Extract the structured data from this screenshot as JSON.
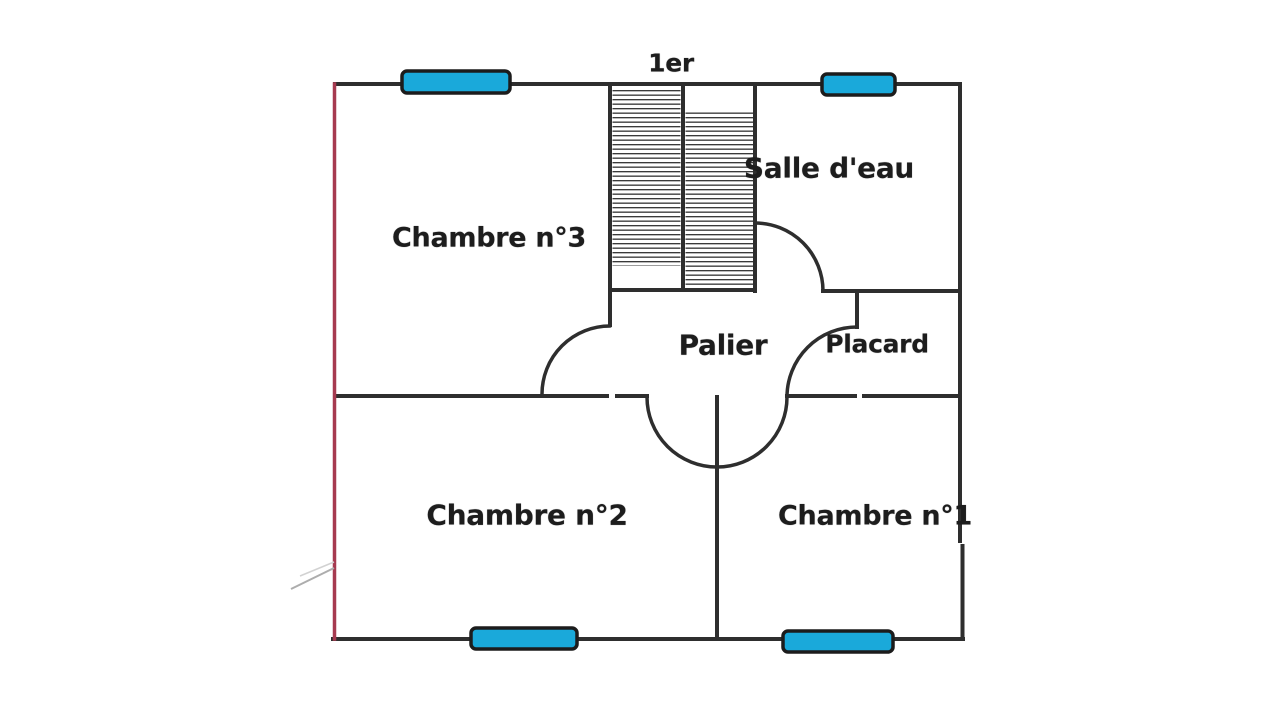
{
  "floor_label": "1er",
  "rooms": {
    "chambre3": "Chambre n°3",
    "salle_eau": "Salle d'eau",
    "palier": "Palier",
    "placard": "Placard",
    "chambre2": "Chambre n°2",
    "chambre1": "Chambre n°1"
  },
  "colors": {
    "wall": "#2e2e2e",
    "exterior_left_wall": "#a63a50",
    "window_fill": "#1aa9da",
    "window_border": "#1c1c1c",
    "stair_tread": "#3a3a3a"
  }
}
